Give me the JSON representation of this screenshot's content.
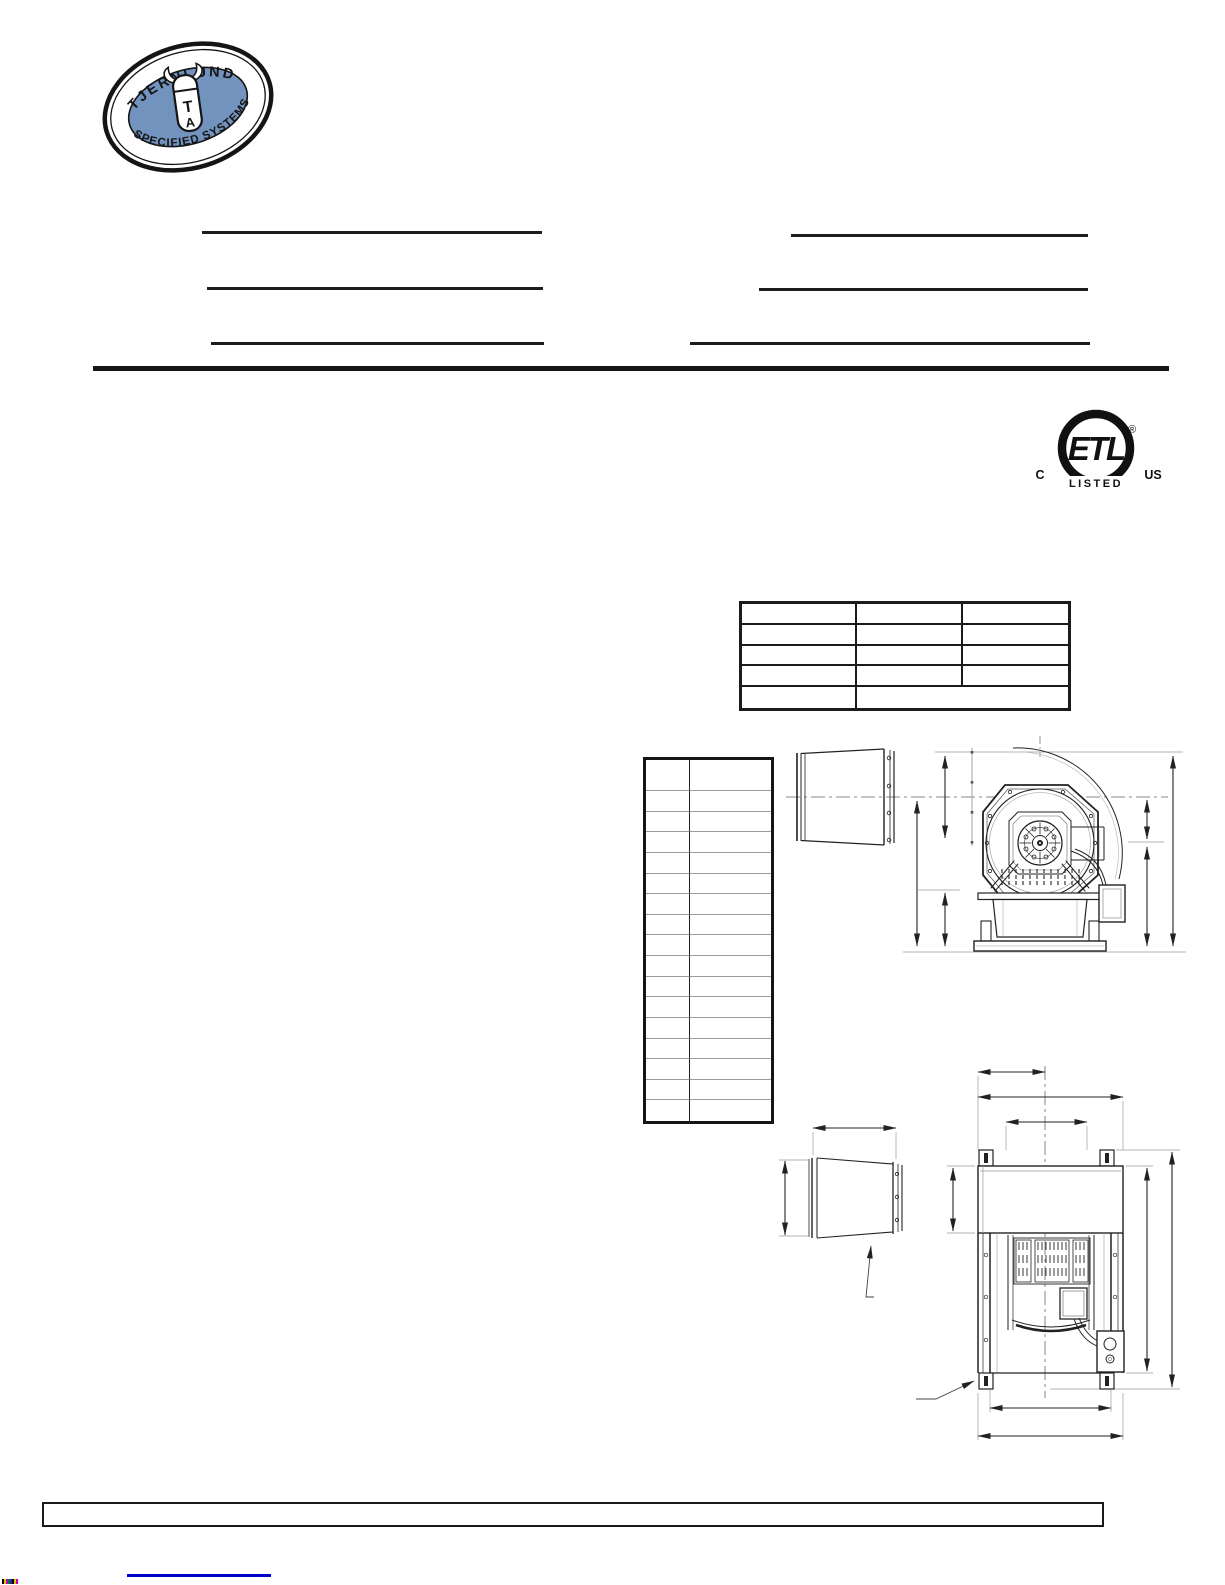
{
  "page": {
    "width": 1225,
    "height": 1585,
    "background": "#ffffff"
  },
  "colors": {
    "ink": "#1d1d1d",
    "thin_table_line": "#9c9c9c",
    "extension_gray": "#b3b3b3",
    "link_blue": "#0000cc",
    "logo_blue": "#7293bd"
  },
  "logo": {
    "arc_top": "TJERNLUND",
    "arc_bottom": "SPECIFIED SYSTEMS",
    "monogram_t": "T",
    "monogram_a": "A"
  },
  "form": {
    "left_lines": [
      {
        "value": ""
      },
      {
        "value": ""
      },
      {
        "value": ""
      }
    ],
    "right_lines": [
      {
        "value": ""
      },
      {
        "value": ""
      },
      {
        "value": ""
      }
    ]
  },
  "etl": {
    "center": "ETL",
    "registered": "®",
    "left": "C",
    "right": "US",
    "banner": "LISTED"
  },
  "top_table": {
    "rows": 5,
    "columns": 3,
    "last_row_merged": true,
    "cells_all_empty": true
  },
  "left_table": {
    "rows": 17,
    "columns": 2,
    "header_row_taller": true,
    "cells_all_empty": true
  },
  "footer": {
    "box_value": "",
    "link_text": ""
  }
}
